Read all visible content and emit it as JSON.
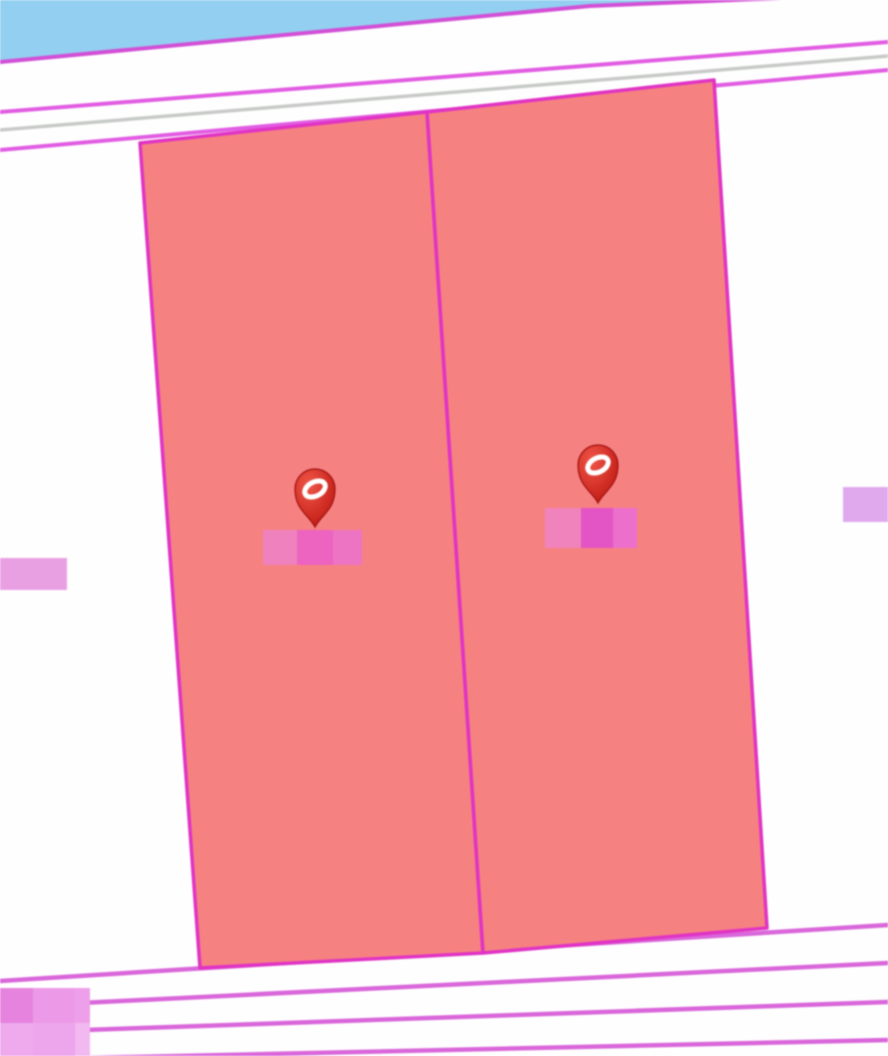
{
  "canvas": {
    "width": 888,
    "height": 1056,
    "background_color": "#FEFEFE"
  },
  "palette": {
    "water": "#93CFF1",
    "parcel_highlight_fill": "#F68181",
    "parcel_border": "#E033C4",
    "shoreline_boundary": "#D24FD6",
    "road_edge_magenta": "#E15CE2",
    "road_center_gray": "#C7CAC7",
    "lot_line": "#D966DA",
    "pin_red": "#D32A1E",
    "redaction_pink": "#EC63C0",
    "redaction_orchid": "#E9A0E3"
  },
  "water_area": {
    "name": "water-area",
    "fill": "#93CFF1",
    "polygon": [
      [
        0,
        0
      ],
      [
        780,
        0
      ],
      [
        590,
        6
      ],
      [
        0,
        64
      ]
    ]
  },
  "boundary_lines": [
    {
      "name": "shoreline-boundary-line",
      "points": [
        [
          0,
          62
        ],
        [
          590,
          6
        ],
        [
          782,
          -2
        ]
      ],
      "color": "#D24FD6",
      "width": 4
    },
    {
      "name": "road-upper-edge-line",
      "points": [
        [
          0,
          112
        ],
        [
          888,
          42
        ]
      ],
      "color": "#E15CE2",
      "width": 4
    },
    {
      "name": "road-centerline-gray",
      "points": [
        [
          0,
          130
        ],
        [
          888,
          56
        ]
      ],
      "color": "#C7CAC7",
      "width": 3.5
    },
    {
      "name": "road-lower-edge-line",
      "points": [
        [
          0,
          150
        ],
        [
          888,
          70
        ]
      ],
      "color": "#E15CE2",
      "width": 4
    },
    {
      "name": "lot-line-1",
      "points": [
        [
          0,
          981
        ],
        [
          888,
          925
        ]
      ],
      "color": "#D966DA",
      "width": 4.5
    },
    {
      "name": "lot-line-2",
      "points": [
        [
          0,
          1007
        ],
        [
          888,
          963
        ]
      ],
      "color": "#D966DA",
      "width": 4.5
    },
    {
      "name": "lot-line-3",
      "points": [
        [
          0,
          1033
        ],
        [
          888,
          1002
        ]
      ],
      "color": "#D966DA",
      "width": 4.5
    },
    {
      "name": "lot-line-4",
      "points": [
        [
          0,
          1060
        ],
        [
          888,
          1040
        ]
      ],
      "color": "#D966DA",
      "width": 4.5
    }
  ],
  "parcels": [
    {
      "name": "highlighted-parcel-west",
      "polygon": [
        [
          140,
          143
        ],
        [
          427,
          112
        ],
        [
          483,
          953
        ],
        [
          200,
          968
        ]
      ],
      "fill": "#F68181",
      "stroke": "#E033C4",
      "stroke_width": 3.5
    },
    {
      "name": "highlighted-parcel-east",
      "polygon": [
        [
          427,
          112
        ],
        [
          714,
          80
        ],
        [
          767,
          928
        ],
        [
          483,
          953
        ]
      ],
      "fill": "#F68181",
      "stroke": "#E033C4",
      "stroke_width": 3.5
    }
  ],
  "markers": [
    {
      "name": "parcel-pin-west",
      "tip_x": 315,
      "tip_y": 527
    },
    {
      "name": "parcel-pin-east",
      "tip_x": 598,
      "tip_y": 503
    }
  ],
  "pin_style": {
    "body_color_top": "#F05548",
    "body_color_bottom": "#BE1810",
    "outline_color": "#A01010",
    "ring_color": "#FFFFFF",
    "balloon_radius": 20,
    "height": 58
  },
  "redaction_blocks": [
    {
      "name": "redacted-label-west",
      "cells": [
        [
          263,
          530,
          34,
          35,
          "#EF82BE"
        ],
        [
          297,
          530,
          36,
          35,
          "#EC63C0"
        ],
        [
          333,
          530,
          29,
          35,
          "#ED74C2"
        ]
      ]
    },
    {
      "name": "redacted-label-east",
      "cells": [
        [
          545,
          508,
          36,
          40,
          "#F083BC"
        ],
        [
          581,
          508,
          32,
          40,
          "#E354C4"
        ],
        [
          613,
          508,
          24,
          40,
          "#EC6FCC"
        ]
      ]
    },
    {
      "name": "redacted-label-left-edge",
      "cells": [
        [
          0,
          558,
          67,
          32,
          "#E9A0E3"
        ]
      ]
    },
    {
      "name": "redacted-label-right-edge",
      "cells": [
        [
          843,
          487,
          45,
          35,
          "#E0A9EE"
        ]
      ]
    },
    {
      "name": "redacted-label-bottom-left",
      "cells": [
        [
          0,
          988,
          33,
          35,
          "#E583DE"
        ],
        [
          33,
          988,
          42,
          35,
          "#EC9AE8"
        ],
        [
          75,
          988,
          15,
          35,
          "#EE9FE9"
        ],
        [
          0,
          1023,
          33,
          33,
          "#EFA9ED"
        ],
        [
          33,
          1023,
          42,
          33,
          "#EDA5EB"
        ],
        [
          75,
          1023,
          15,
          33,
          "#F2B8F0"
        ]
      ]
    }
  ]
}
